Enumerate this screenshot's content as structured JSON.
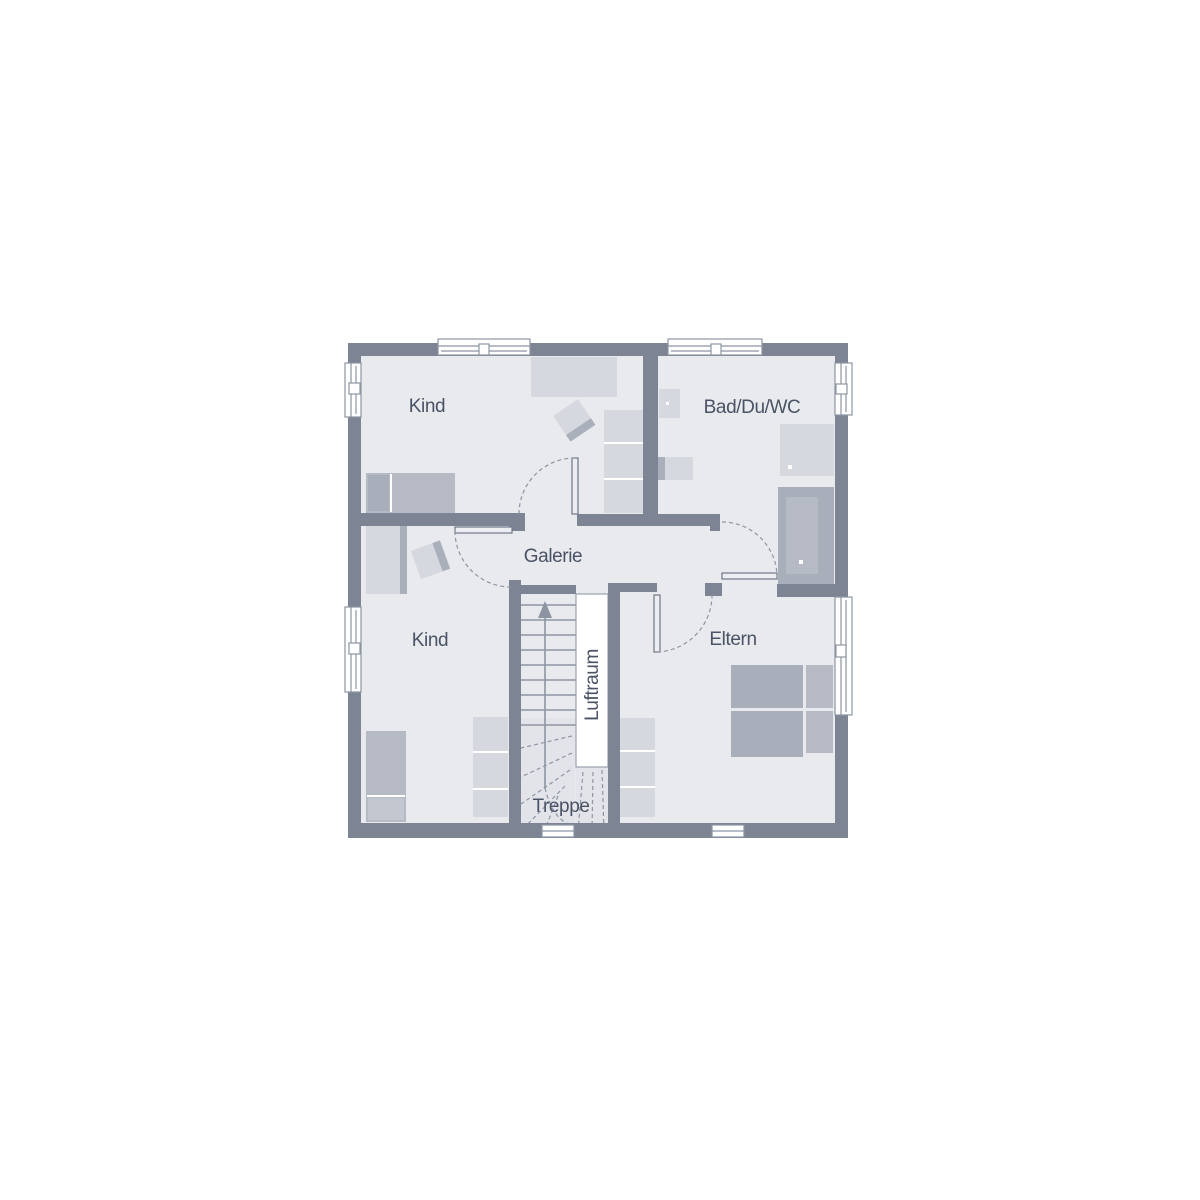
{
  "floor_plan": {
    "labels": {
      "room_kind_top": "Kind",
      "room_bad": "Bad/Du/WC",
      "room_galerie": "Galerie",
      "room_kind_bottom": "Kind",
      "room_eltern": "Eltern",
      "void": "Luftraum",
      "stairs": "Treppe"
    },
    "colors": {
      "wall": "#7d8594",
      "floor": "#e8eaee",
      "floor_shade": "#e2e4ea",
      "furn_light": "#d5d8de",
      "furn_front": "#a9afbb",
      "furn_med": "#b5bac5",
      "furn_dark": "#a8aeba",
      "bed_pillow": "#c3c7d0",
      "line": "#8d95a3",
      "leaf": "#eceef2",
      "leaf_border": "#6e7687",
      "text": "#4a5365",
      "white": "#ffffff"
    }
  }
}
